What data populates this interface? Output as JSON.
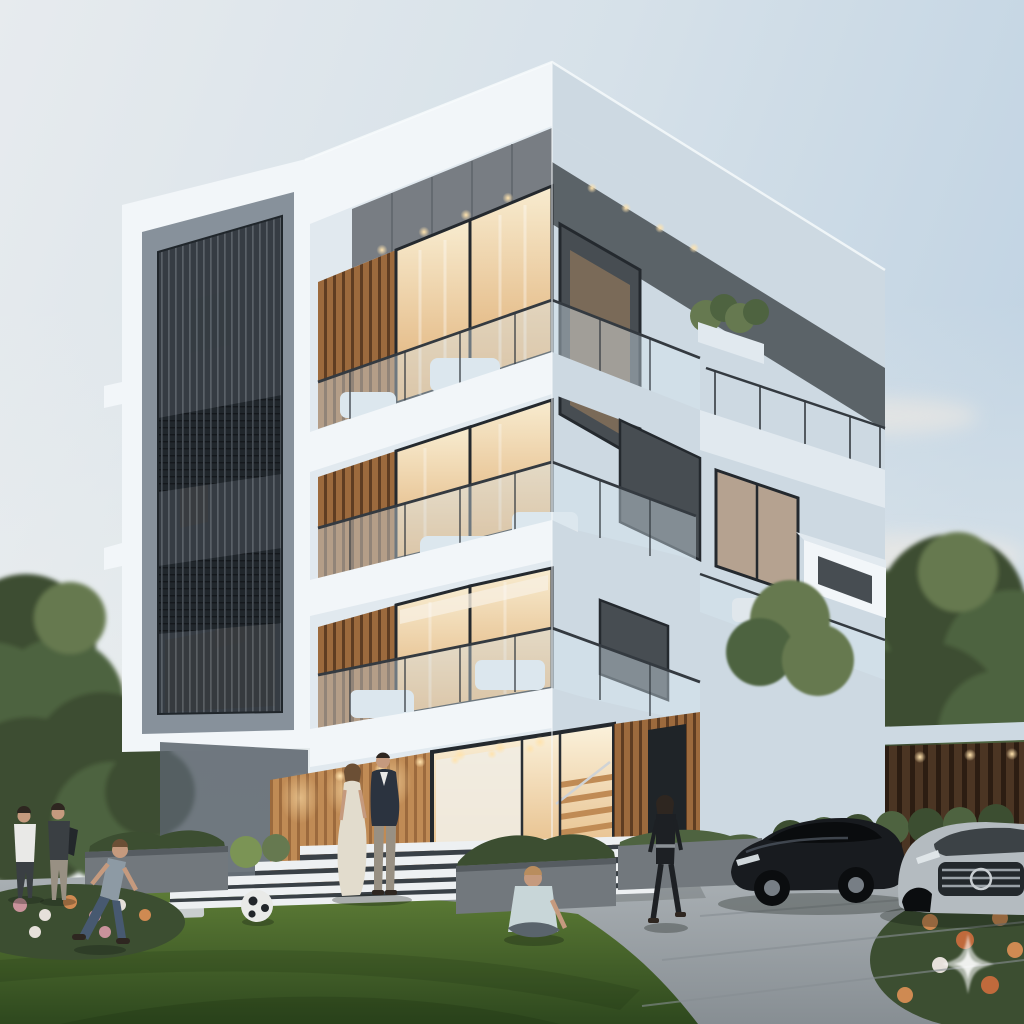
{
  "canvas": {
    "width": 1024,
    "height": 1024
  },
  "scene": {
    "type": "photorealistic-architectural-render",
    "objects": [
      "four-storey-modern-white-building",
      "wraparound-glass-balconies-with-furniture",
      "warm-lit-interiors-at-dusk",
      "perforated-metal-screen-bay",
      "wood-slat-facade-panels",
      "glass-entry-with-wooden-staircase",
      "white-entrance-steps",
      "stone-planters-with-grasses",
      "front-lawn",
      "stepping-stone-path",
      "flower-beds",
      "couple-on-entrance-steps",
      "two-men-talking",
      "boy-running-with-soccer-ball",
      "toddler-sitting-on-lawn",
      "woman-walking-on-driveway",
      "black-luxury-sedan",
      "silver-luxury-car",
      "wood-slat-garage-with-downlights",
      "neighbor-gable-roof-house",
      "background-trees-and-hedges",
      "pale-dusk-sky-with-soft-clouds",
      "sparkle-watermark-icon"
    ]
  },
  "watermark": {
    "icon": "sparkle-watermark-icon"
  },
  "palette": {
    "sky_left": "#e7ebee",
    "sky_mid": "#d6e1e9",
    "sky_right": "#c2d4e3",
    "sky_low": "#edf0ef",
    "cloud": "#f5ece2",
    "white_hi": "#f2f6f9",
    "white_mid": "#e1e9ef",
    "white_shade": "#cdd9e2",
    "soffit": "#9fabb5",
    "frame_gray": "#98a2ac",
    "panel_gray": "#87919b",
    "recess_dark": "#59636b",
    "screen_dark": "#2f353b",
    "screen_band": "#20262b",
    "screen_line": "#565d64",
    "wood": "#9c6a3d",
    "wood_dark": "#5f3d22",
    "wood_lit": "#c08b55",
    "warm_hi": "#f8ecd0",
    "warm_lo": "#dfae74",
    "entry_hi": "#fbf2dc",
    "entry_lo": "#e2b377",
    "glow": "#ffe3ae",
    "glass_cool": "#aebfcb",
    "glass_dark": "#474d52",
    "taupe": "#b5a290",
    "frame_dark": "#24292e",
    "mullion": "#3a4045",
    "rail_glass": "rgba(215,230,240,0.42)",
    "rail_metal": "#343a40",
    "furniture": "#e0e7ec",
    "grass_hi": "#5d7c36",
    "grass_lo": "#2e481e",
    "tree_dark": "#3c4e31",
    "tree_mid": "#4e6340",
    "tree_lit": "#667950",
    "bush_lit": "#7b9455",
    "pave_hi": "#b0b6ba",
    "pave_lo": "#878e93",
    "stone": "#c9cecf",
    "step_white": "#edf0f2",
    "step_dark": "#394046",
    "planter": "#72787d",
    "planter_dark": "#565c61",
    "house_wall": "#e6e7e5",
    "house_roof": "#8e9499",
    "house_win": "#4a5055",
    "garage_wood": "#4b3523",
    "garage_slat": "#2c1d12",
    "garage_gray": "#6a7277",
    "car_black": "#181b1f",
    "car_glass": "#0a0c0e",
    "car_hl": "#4b535c",
    "car_silver": "#b4bbc0",
    "car_silver_lo": "#8b9298",
    "grille": "#23282c",
    "wheel": "#0b0d0f",
    "rim": "#777e85",
    "skin": "#c59a7e",
    "hair_dark": "#2e2620",
    "hair_brown": "#6b4f35",
    "hair_blond": "#b98d5e",
    "dress": "#e2dccd",
    "suit": "#2b333f",
    "trouser": "#989083",
    "shirt": "#e9e9e7",
    "tee_dark": "#3a3f43",
    "denim": "#475970",
    "kid_shirt": "#c8d6d8",
    "black_outfit": "#1d2024",
    "ball": "#e9eae8",
    "ball_dark": "#22262a",
    "shadow": "rgba(18,24,16,0.30)",
    "watermark": "rgba(255,255,255,0.58)"
  }
}
